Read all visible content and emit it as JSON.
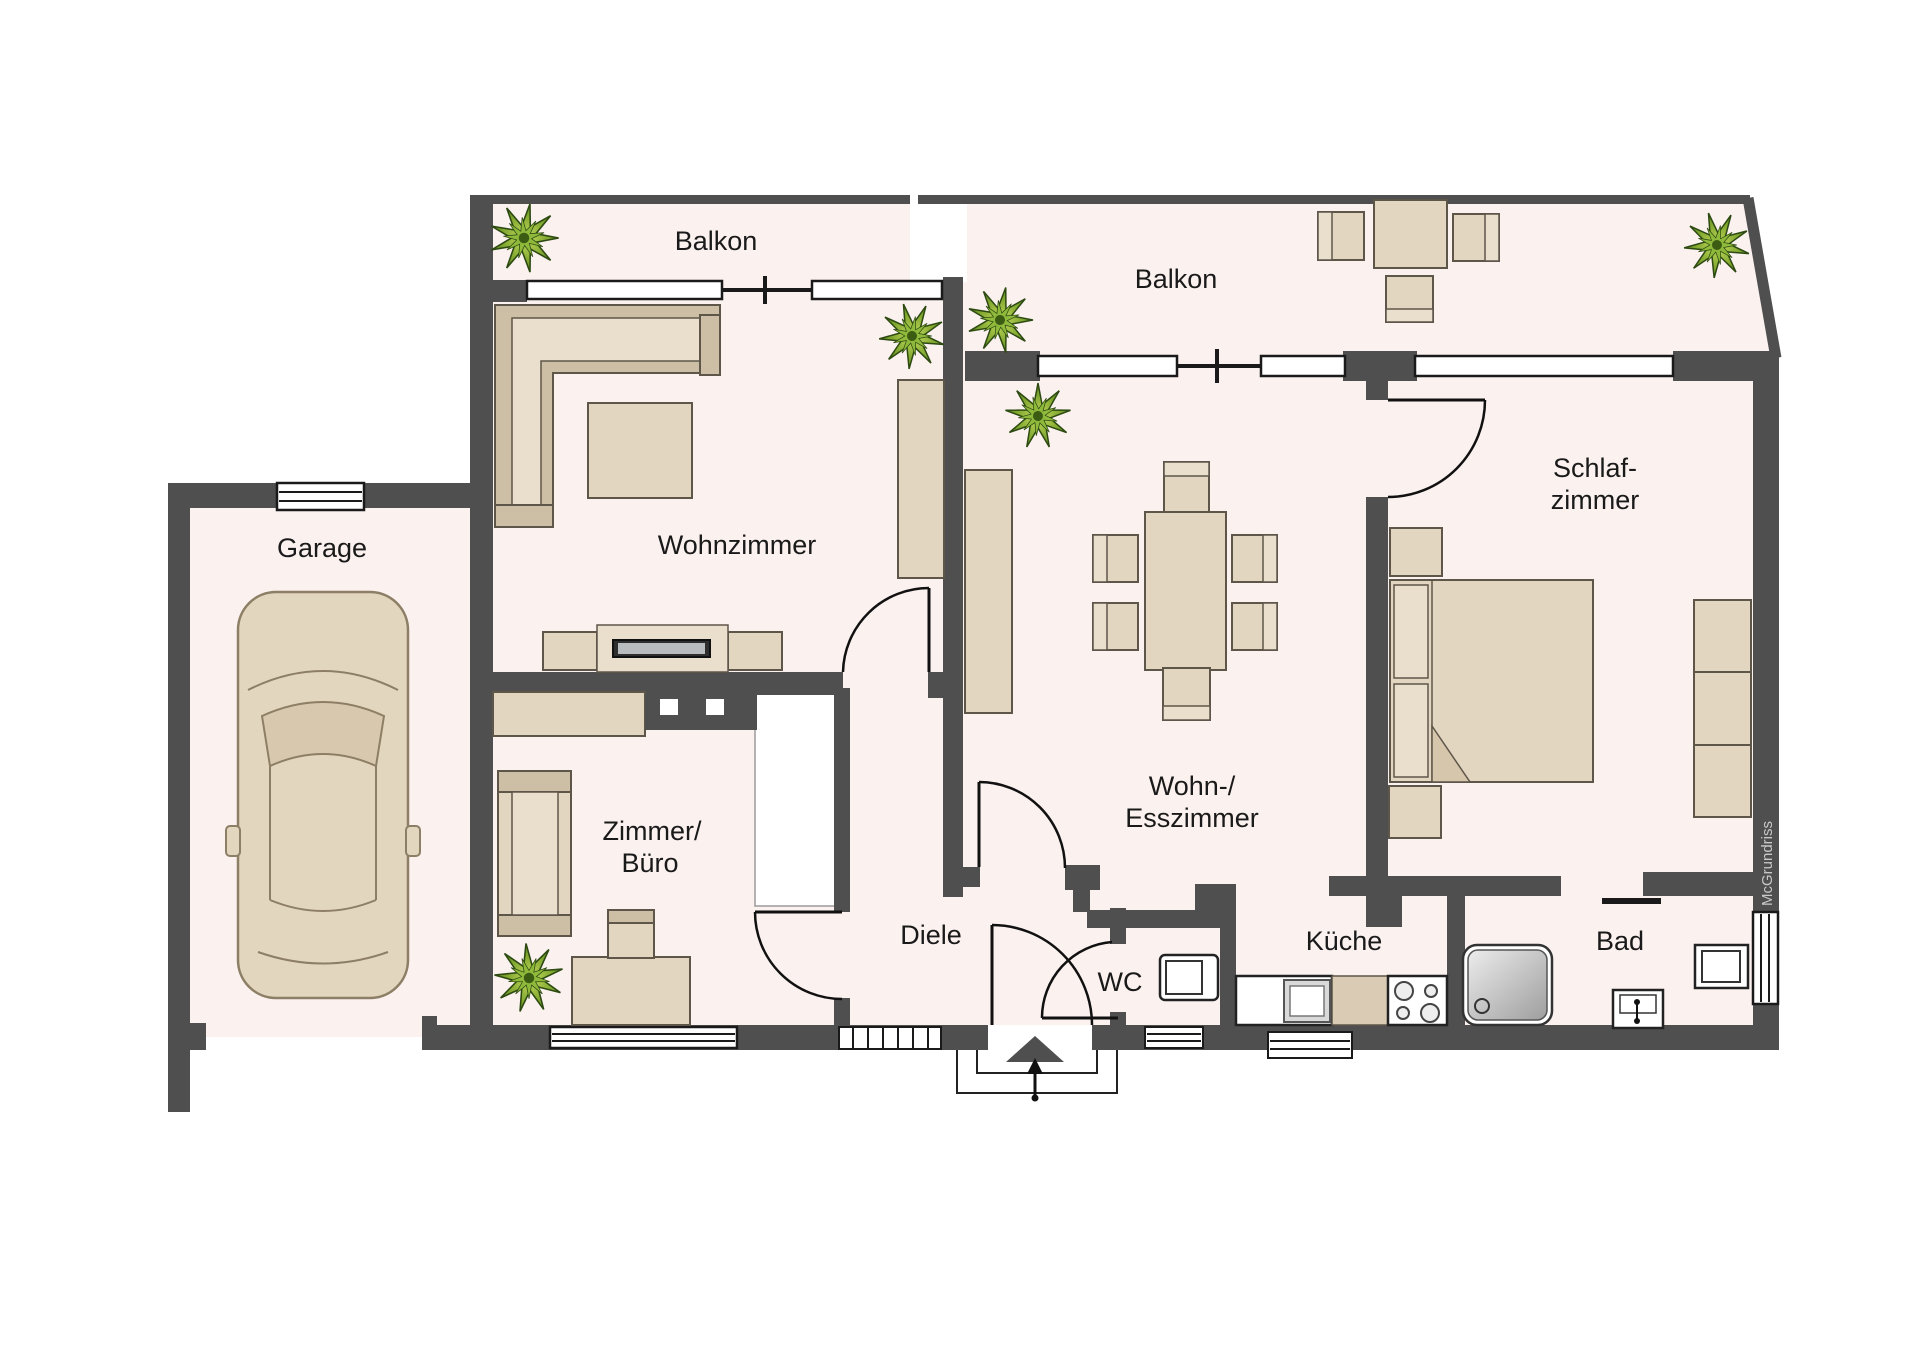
{
  "branding": {
    "watermark": "McGrundriss"
  },
  "rooms": {
    "balcony_left": {
      "label": "Balkon"
    },
    "balcony_right": {
      "label": "Balkon"
    },
    "living": {
      "label": "Wohnzimmer"
    },
    "garage": {
      "label": "Garage"
    },
    "office": {
      "label_line1": "Zimmer/",
      "label_line2": "Büro"
    },
    "hall": {
      "label": "Diele"
    },
    "wc": {
      "label": "WC"
    },
    "dining": {
      "label_line1": "Wohn-/",
      "label_line2": "Esszimmer"
    },
    "kitchen": {
      "label": "Küche"
    },
    "bath": {
      "label": "Bad"
    },
    "bedroom": {
      "label_line1": "Schlaf-",
      "label_line2": "zimmer"
    }
  },
  "colors": {
    "wall": "#4f4f4f",
    "floor": "#fbf1ef",
    "furniture": "#e2d6c0",
    "furniture_dark": "#cdbfa5",
    "plant_mid": "#8fb93a",
    "plant_dark": "#3c5c14",
    "text": "#1a1a1a",
    "watermark": "#c9c9c9"
  }
}
